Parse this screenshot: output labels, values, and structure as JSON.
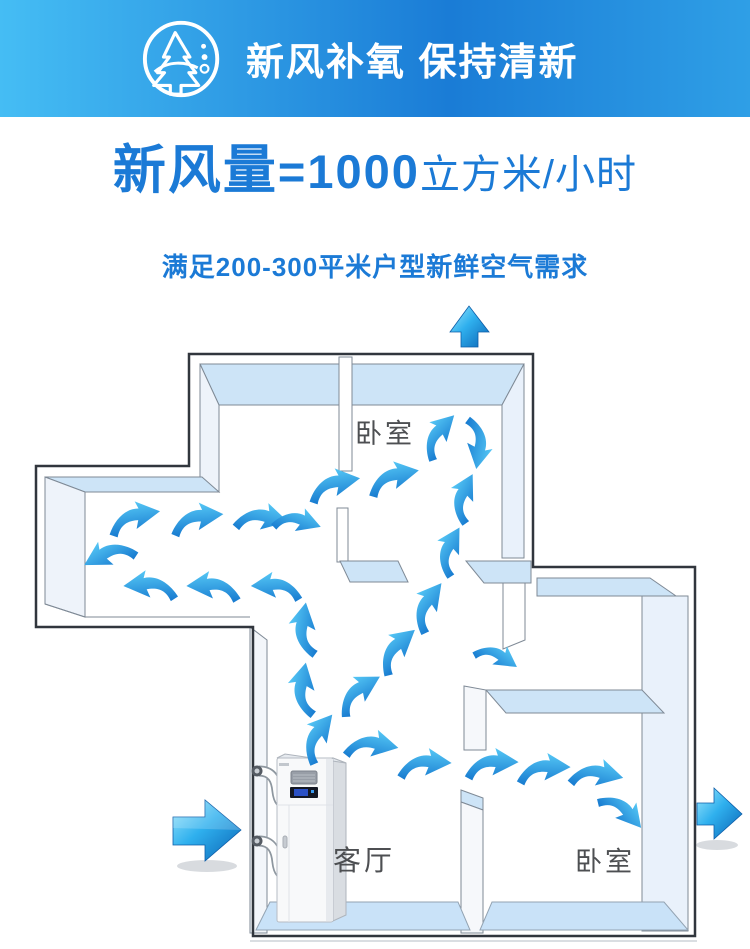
{
  "header": {
    "title": "新风补氧 保持清新",
    "icon": "fresh-air-tree-icon"
  },
  "headline": {
    "label": "新风量",
    "value": "=1000",
    "unit": "立方米/小时"
  },
  "subtitle": "满足200-300平米户型新鲜空气需求",
  "diagram": {
    "rooms": {
      "bedroom_top": "卧室",
      "living_room": "客厅",
      "bedroom_bottom": "卧室"
    },
    "airflow": {
      "inlet_arrow": "left-inlet-arrow",
      "outlet_arrows": [
        "top-outlet-arrow",
        "right-outlet-arrow"
      ],
      "curved_arrow_count": 27
    },
    "equipment": "fresh-air-ventilation-unit"
  },
  "colors": {
    "accent": "#1b7ad6",
    "label": "#4d4f52",
    "arrow_blue_light": "#55c7f5",
    "arrow_blue_dark": "#1679cf",
    "wall_top_face": "#cde4f7",
    "floor": "#c9e2f8"
  },
  "header_gradient": [
    "#45bdf4",
    "#1a7cd6",
    "#2f9fe6"
  ]
}
